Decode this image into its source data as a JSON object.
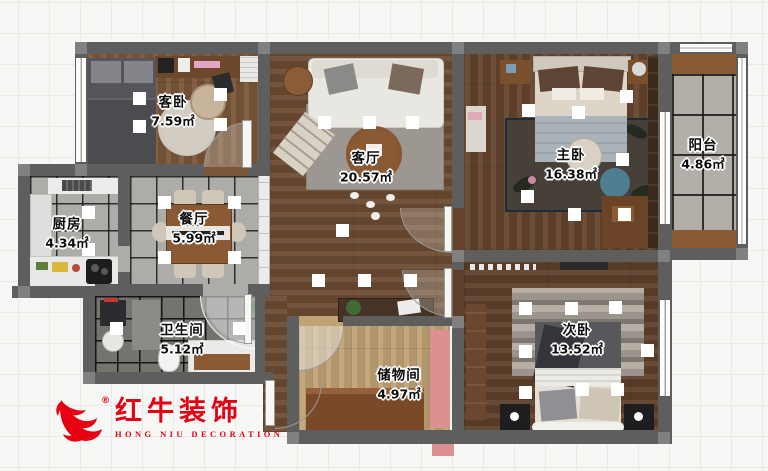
{
  "floorplan": {
    "rooms": [
      {
        "id": "guest-bedroom",
        "name": "客卧",
        "area": "7.59㎡"
      },
      {
        "id": "living-room",
        "name": "客厅",
        "area": "20.57㎡"
      },
      {
        "id": "master-bedroom",
        "name": "主卧",
        "area": "16.38㎡"
      },
      {
        "id": "balcony",
        "name": "阳台",
        "area": "4.86㎡"
      },
      {
        "id": "kitchen",
        "name": "厨房",
        "area": "4.34㎡"
      },
      {
        "id": "dining-room",
        "name": "餐厅",
        "area": "5.99㎡"
      },
      {
        "id": "bathroom",
        "name": "卫生间",
        "area": "5.12㎡"
      },
      {
        "id": "storage-room",
        "name": "储物间",
        "area": "4.97㎡"
      },
      {
        "id": "second-bedroom",
        "name": "次卧",
        "area": "13.52㎡"
      }
    ]
  },
  "logo": {
    "brand_cn": "红牛装饰",
    "brand_en": "HONG NIU DECORATION",
    "registered_mark": "®",
    "color": "#e60012"
  },
  "colors": {
    "wall": "#5e5e5e",
    "wood_dark": "#6b4a31",
    "wood_light": "#c0a275",
    "tile_gray": "#aeaca8",
    "bath_tile": "#75736e",
    "pink_accent": "#dd9090",
    "logo_red": "#e60012"
  }
}
